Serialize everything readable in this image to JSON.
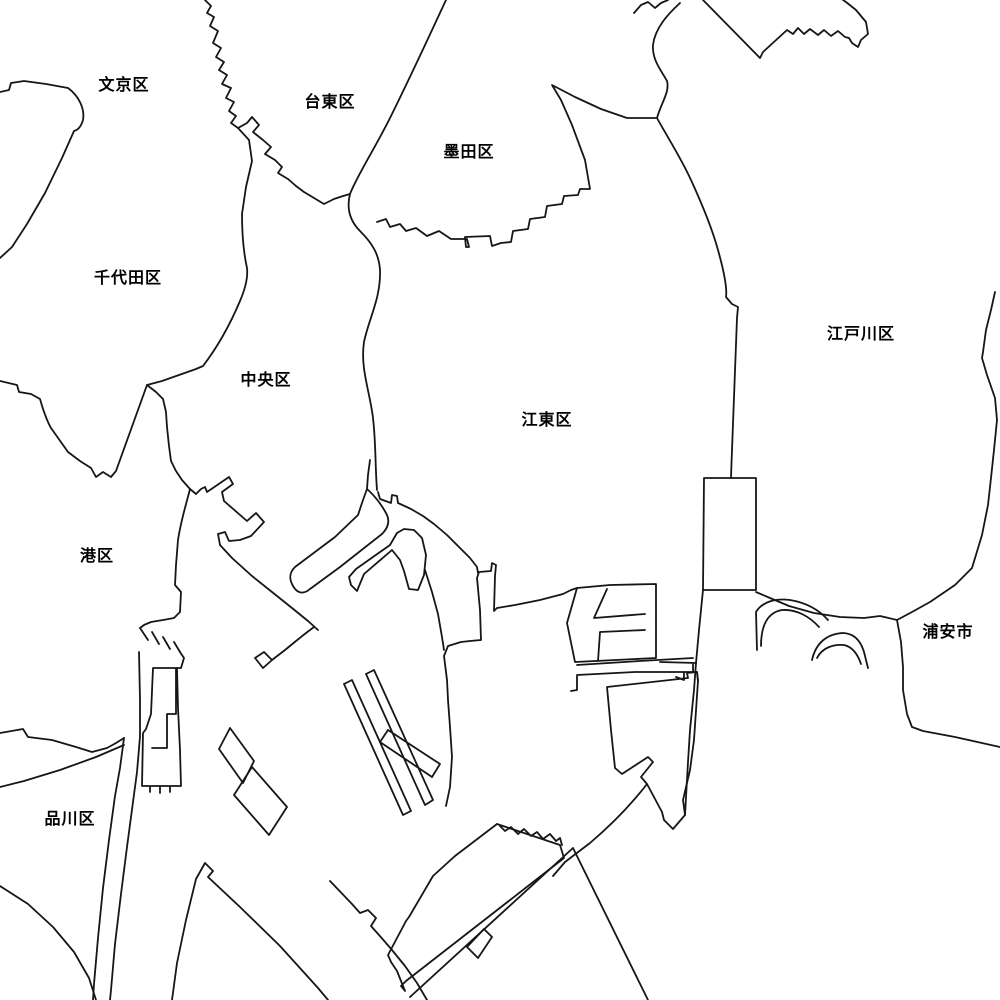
{
  "map": {
    "title": "Tokyo bay-area ward boundary map",
    "background_color": "#ffffff",
    "line_color": "#161616",
    "labels": [
      {
        "name": "bunkyo",
        "text": "文京区",
        "x": 124,
        "y": 83
      },
      {
        "name": "taito",
        "text": "台東区",
        "x": 330,
        "y": 100
      },
      {
        "name": "sumida",
        "text": "墨田区",
        "x": 469,
        "y": 150
      },
      {
        "name": "chiyoda",
        "text": "千代田区",
        "x": 128,
        "y": 276
      },
      {
        "name": "chuo",
        "text": "中央区",
        "x": 266,
        "y": 378
      },
      {
        "name": "koto",
        "text": "江東区",
        "x": 547,
        "y": 418
      },
      {
        "name": "edogawa",
        "text": "江戸川区",
        "x": 861,
        "y": 332
      },
      {
        "name": "minato",
        "text": "港区",
        "x": 97,
        "y": 554
      },
      {
        "name": "urayasu",
        "text": "浦安市",
        "x": 948,
        "y": 630
      },
      {
        "name": "shinagawa",
        "text": "品川区",
        "x": 70,
        "y": 817
      }
    ]
  }
}
